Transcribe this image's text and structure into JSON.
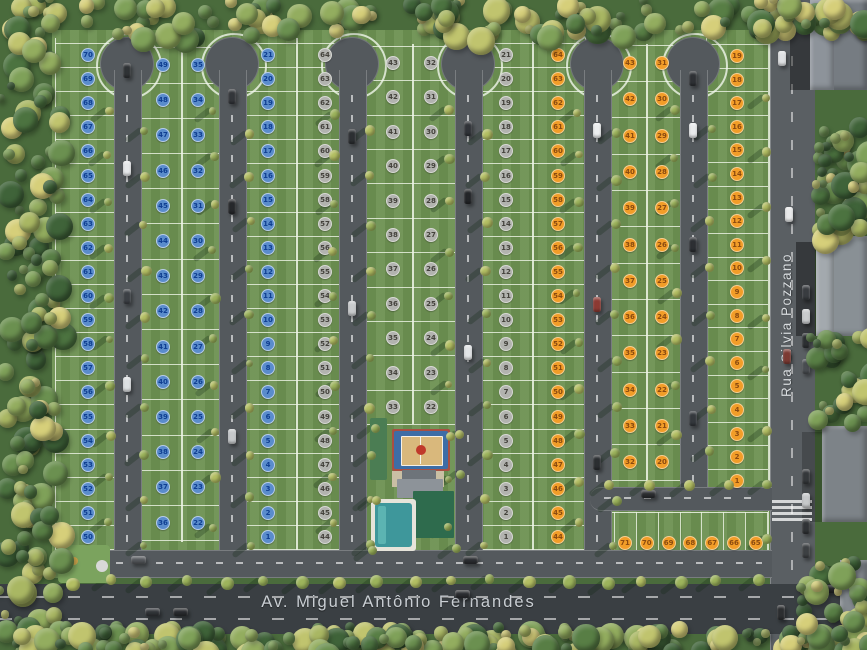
{
  "scene": {
    "type": "masterplan-aerial",
    "streets": {
      "bottom_avenue": "Av. Miguel Antônio Fernandes",
      "right_street": "Rua Silvia Pozzano"
    },
    "colors": {
      "lawn": "#6d9151",
      "lot_line": "#eef4e6",
      "internal_road": "#54595d",
      "avenue": "#3a3f43",
      "right_road": "#5a5f63"
    },
    "marker_styles": {
      "blue": {
        "fill": "#5a8ccc",
        "ring": "#b7cdea",
        "text": "#0f3e91"
      },
      "gray": {
        "fill": "#b2b3af",
        "ring": "#d8d9d5",
        "text": "#44423c"
      },
      "orange": {
        "fill": "#f29d28",
        "ring": "#f7cf92",
        "text": "#8a4a10"
      }
    },
    "blocks": [
      {
        "name": "block-left",
        "marker": "blue",
        "columns": [
          {
            "x1": 55,
            "x2": 114,
            "y1": 38,
            "y2": 550,
            "cx": 88,
            "y0": 55,
            "dy": 24.1,
            "numbers": [
              70,
              69,
              68,
              67,
              66,
              65,
              64,
              63,
              62,
              61,
              60,
              59,
              58,
              57,
              56,
              55,
              54,
              53,
              52,
              51,
              50
            ]
          },
          {
            "x1": 140,
            "x2": 181,
            "y1": 44,
            "y2": 542,
            "cx": 163,
            "y0": 65,
            "dy": 35.2,
            "numbers": [
              49,
              48,
              47,
              46,
              45,
              44,
              43,
              42,
              41,
              40,
              39,
              38,
              37,
              36
            ]
          },
          {
            "x1": 181,
            "x2": 219,
            "y1": 44,
            "y2": 542,
            "cx": 198,
            "y0": 65,
            "dy": 35.2,
            "numbers": [
              35,
              34,
              33,
              32,
              31,
              30,
              29,
              28,
              27,
              26,
              25,
              24,
              23,
              22
            ]
          },
          {
            "x1": 245,
            "x2": 296,
            "y1": 38,
            "y2": 550,
            "cx": 268,
            "y0": 55,
            "dy": 24.1,
            "numbers": [
              21,
              20,
              19,
              18,
              17,
              16,
              15,
              14,
              13,
              12,
              11,
              10,
              9,
              8,
              7,
              6,
              5,
              4,
              3,
              2,
              1
            ]
          }
        ]
      },
      {
        "name": "block-middle",
        "marker": "gray",
        "columns": [
          {
            "x1": 296,
            "x2": 339,
            "y1": 38,
            "y2": 550,
            "cx": 325,
            "y0": 55,
            "dy": 24.1,
            "numbers": [
              64,
              63,
              62,
              61,
              60,
              59,
              58,
              57,
              56,
              55,
              54,
              53,
              52,
              51,
              50,
              49,
              48,
              47,
              46,
              45,
              44
            ]
          },
          {
            "x1": 365,
            "x2": 412,
            "y1": 44,
            "y2": 424,
            "cx": 393,
            "y0": 63,
            "dy": 34.4,
            "numbers": [
              43,
              42,
              41,
              40,
              39,
              38,
              37,
              36,
              35,
              34,
              33
            ]
          },
          {
            "x1": 412,
            "x2": 455,
            "y1": 44,
            "y2": 424,
            "cx": 431,
            "y0": 63,
            "dy": 34.4,
            "numbers": [
              32,
              31,
              30,
              29,
              28,
              27,
              26,
              25,
              24,
              23,
              22
            ]
          },
          {
            "x1": 481,
            "x2": 532,
            "y1": 38,
            "y2": 550,
            "cx": 506,
            "y0": 55,
            "dy": 24.1,
            "numbers": [
              21,
              20,
              19,
              18,
              17,
              16,
              15,
              14,
              13,
              12,
              11,
              10,
              9,
              8,
              7,
              6,
              5,
              4,
              3,
              2,
              1
            ]
          }
        ]
      },
      {
        "name": "block-right",
        "marker": "orange",
        "columns": [
          {
            "x1": 532,
            "x2": 584,
            "y1": 38,
            "y2": 550,
            "cx": 558,
            "y0": 55,
            "dy": 24.1,
            "numbers": [
              64,
              63,
              62,
              61,
              60,
              59,
              58,
              57,
              56,
              55,
              54,
              53,
              52,
              51,
              50,
              49,
              48,
              47,
              46,
              45,
              44
            ]
          },
          {
            "x1": 610,
            "x2": 646,
            "y1": 44,
            "y2": 482,
            "cx": 630,
            "y0": 63,
            "dy": 36.3,
            "numbers": [
              43,
              42,
              41,
              40,
              39,
              38,
              37,
              36,
              35,
              34,
              33,
              32
            ]
          },
          {
            "x1": 646,
            "x2": 680,
            "y1": 44,
            "y2": 482,
            "cx": 662,
            "y0": 63,
            "dy": 36.3,
            "numbers": [
              31,
              30,
              29,
              28,
              27,
              26,
              25,
              24,
              23,
              22,
              21,
              20
            ]
          },
          {
            "x1": 706,
            "x2": 768,
            "y1": 38,
            "y2": 494,
            "cx": 737,
            "y0": 56,
            "dy": 23.6,
            "numbers": [
              19,
              18,
              17,
              16,
              15,
              14,
              13,
              12,
              11,
              10,
              9,
              8,
              7,
              6,
              5,
              4,
              3,
              2,
              1
            ]
          }
        ],
        "row": {
          "x1": 612,
          "x2": 768,
          "y1": 512,
          "y2": 572,
          "cy": 543,
          "x0": 625,
          "dx": 21.8,
          "numbers": [
            71,
            70,
            69,
            68,
            67,
            66,
            65
          ]
        }
      }
    ],
    "roads": {
      "width": 26,
      "bulb_cy": 64,
      "bulb_r": 27,
      "vertical": [
        {
          "cx": 127,
          "top": 70,
          "bottom": 576,
          "bulb": true
        },
        {
          "cx": 232,
          "top": 70,
          "bottom": 576,
          "bulb": true
        },
        {
          "cx": 352,
          "top": 70,
          "bottom": 576,
          "bulb": true
        },
        {
          "cx": 468,
          "top": 70,
          "bottom": 576,
          "bulb": true
        },
        {
          "cx": 597,
          "top": 70,
          "bottom": 576,
          "bulb": true
        },
        {
          "cx": 693,
          "top": 70,
          "bottom": 505,
          "bulb": true
        }
      ],
      "connector": {
        "x": 590,
        "y": 487,
        "w": 182,
        "h": 22
      },
      "bottom": {
        "x": 96,
        "y": 550,
        "w": 676,
        "h": 26
      },
      "crosswalk": {
        "x": 772,
        "y": 500,
        "w": 40,
        "bars": 4
      }
    },
    "amenities": {
      "structures": [
        {
          "n": "annex-green-roof",
          "x": 370,
          "y": 418,
          "w": 17,
          "h": 62,
          "c": "#4b7d53",
          "r": 2
        },
        {
          "n": "sports-court-frame",
          "x": 392,
          "y": 429,
          "w": 58,
          "h": 42,
          "c": "#a94f42",
          "r": 2
        },
        {
          "n": "sports-court-apron",
          "x": 394,
          "y": 431,
          "w": 54,
          "h": 38,
          "c": "#3e6da6",
          "r": 2
        },
        {
          "n": "sports-court-floor",
          "x": 401,
          "y": 436,
          "w": 40,
          "h": 28,
          "c": "#d9b87c",
          "r": 1,
          "b": "1px solid rgba(255,255,255,.8)"
        },
        {
          "n": "court-center-line",
          "x": 420,
          "y": 436,
          "w": 1,
          "h": 28,
          "c": "#f5f5f0"
        },
        {
          "n": "court-center-circle",
          "x": 416,
          "y": 445,
          "w": 10,
          "h": 10,
          "c": "#c0392b",
          "r": 50
        },
        {
          "n": "plaza-paving",
          "x": 392,
          "y": 471,
          "w": 52,
          "h": 16,
          "c": "#c9bfa4"
        },
        {
          "n": "clubhouse-roof-dark",
          "x": 402,
          "y": 470,
          "w": 34,
          "h": 12,
          "c": "#6e747a",
          "r": 1
        },
        {
          "n": "clubhouse-roof",
          "x": 397,
          "y": 479,
          "w": 46,
          "h": 19,
          "c": "#8d9399",
          "r": 1
        },
        {
          "n": "clubhouse-green-roof",
          "x": 413,
          "y": 491,
          "w": 41,
          "h": 47,
          "c": "#2e6b4d",
          "r": 1
        },
        {
          "n": "pool-deck",
          "x": 371,
          "y": 499,
          "w": 45,
          "h": 52,
          "c": "#e6e4da",
          "r": 3
        },
        {
          "n": "pool-water",
          "x": 375,
          "y": 503,
          "w": 37,
          "h": 44,
          "c": "#3e979b",
          "r": 3
        },
        {
          "n": "pool-lane",
          "x": 378,
          "y": 506,
          "w": 8,
          "h": 38,
          "c": "#5cb4b2",
          "r": 2
        },
        {
          "n": "playground-lawn",
          "x": 58,
          "y": 545,
          "w": 52,
          "h": 38,
          "c": "#7ba35e",
          "r": 4
        },
        {
          "n": "playground-ring",
          "x": 96,
          "y": 560,
          "w": 12,
          "h": 12,
          "c": "#d8d8d8",
          "r": 50
        },
        {
          "n": "playground-item",
          "x": 70,
          "y": 557,
          "w": 8,
          "h": 8,
          "c": "#c8a14a",
          "r": 50
        }
      ]
    },
    "neighborhood": {
      "buildings": [
        {
          "x": 810,
          "y": 0,
          "w": 57,
          "h": 90,
          "c": "#767c82"
        },
        {
          "x": 810,
          "y": 0,
          "w": 24,
          "h": 90,
          "c": "#8d939a"
        },
        {
          "x": 816,
          "y": 236,
          "w": 51,
          "h": 100,
          "c": "#899095"
        },
        {
          "x": 816,
          "y": 236,
          "w": 18,
          "h": 100,
          "c": "#a3a9ae"
        },
        {
          "x": 822,
          "y": 426,
          "w": 45,
          "h": 96,
          "c": "#7d8388"
        },
        {
          "x": 840,
          "y": 560,
          "w": 27,
          "h": 60,
          "c": "#83898e"
        }
      ]
    },
    "vehicles": [
      {
        "x": 127,
        "y": 70,
        "o": "v",
        "c": "#2f3235"
      },
      {
        "x": 127,
        "y": 168,
        "o": "v",
        "c": "#e6e8ea"
      },
      {
        "x": 127,
        "y": 296,
        "o": "v",
        "c": "#3c4045"
      },
      {
        "x": 127,
        "y": 384,
        "o": "v",
        "c": "#dde0e2"
      },
      {
        "x": 232,
        "y": 96,
        "o": "v",
        "c": "#33363a"
      },
      {
        "x": 232,
        "y": 206,
        "o": "v",
        "c": "#26282b"
      },
      {
        "x": 232,
        "y": 436,
        "o": "v",
        "c": "#c6c9cb"
      },
      {
        "x": 352,
        "y": 136,
        "o": "v",
        "c": "#2c2f32"
      },
      {
        "x": 352,
        "y": 308,
        "o": "v",
        "c": "#c9cbcd"
      },
      {
        "x": 468,
        "y": 128,
        "o": "v",
        "c": "#303338"
      },
      {
        "x": 468,
        "y": 196,
        "o": "v",
        "c": "#232528"
      },
      {
        "x": 468,
        "y": 352,
        "o": "v",
        "c": "#e2e4e6"
      },
      {
        "x": 597,
        "y": 130,
        "o": "v",
        "c": "#eceeef"
      },
      {
        "x": 597,
        "y": 304,
        "o": "v",
        "c": "#8c3a33"
      },
      {
        "x": 597,
        "y": 462,
        "o": "v",
        "c": "#2b2e31"
      },
      {
        "x": 693,
        "y": 78,
        "o": "v",
        "c": "#2e3135"
      },
      {
        "x": 693,
        "y": 130,
        "o": "v",
        "c": "#e8eaeb"
      },
      {
        "x": 693,
        "y": 244,
        "o": "v",
        "c": "#2c2f33"
      },
      {
        "x": 693,
        "y": 418,
        "o": "v",
        "c": "#34383d"
      },
      {
        "x": 648,
        "y": 494,
        "o": "h",
        "c": "#2b2d30"
      },
      {
        "x": 470,
        "y": 560,
        "o": "h",
        "c": "#2c2e31"
      },
      {
        "x": 138,
        "y": 560,
        "o": "h",
        "c": "#55585c"
      },
      {
        "x": 782,
        "y": 58,
        "o": "v",
        "c": "#dfe1e3"
      },
      {
        "x": 789,
        "y": 214,
        "o": "v",
        "c": "#e8e9ea"
      },
      {
        "x": 787,
        "y": 356,
        "o": "v",
        "c": "#7c3a33"
      },
      {
        "x": 781,
        "y": 612,
        "o": "v",
        "c": "#2c2e30"
      },
      {
        "x": 806,
        "y": 292,
        "o": "v",
        "c": "#393c40"
      },
      {
        "x": 806,
        "y": 316,
        "o": "v",
        "c": "#c9cbcd"
      },
      {
        "x": 806,
        "y": 340,
        "o": "v",
        "c": "#2e3134"
      },
      {
        "x": 806,
        "y": 366,
        "o": "v",
        "c": "#4a4e52"
      },
      {
        "x": 806,
        "y": 476,
        "o": "v",
        "c": "#35383b"
      },
      {
        "x": 806,
        "y": 500,
        "o": "v",
        "c": "#c6c8ca"
      },
      {
        "x": 806,
        "y": 526,
        "o": "v",
        "c": "#303336"
      },
      {
        "x": 806,
        "y": 550,
        "o": "v",
        "c": "#3d4043"
      },
      {
        "x": 180,
        "y": 612,
        "o": "h",
        "c": "#2a2c2f"
      },
      {
        "x": 152,
        "y": 612,
        "o": "h",
        "c": "#323539"
      },
      {
        "x": 462,
        "y": 594,
        "o": "h",
        "c": "#2c2e31"
      },
      {
        "x": 832,
        "y": 589,
        "o": "h",
        "c": "#282a2d"
      }
    ]
  }
}
